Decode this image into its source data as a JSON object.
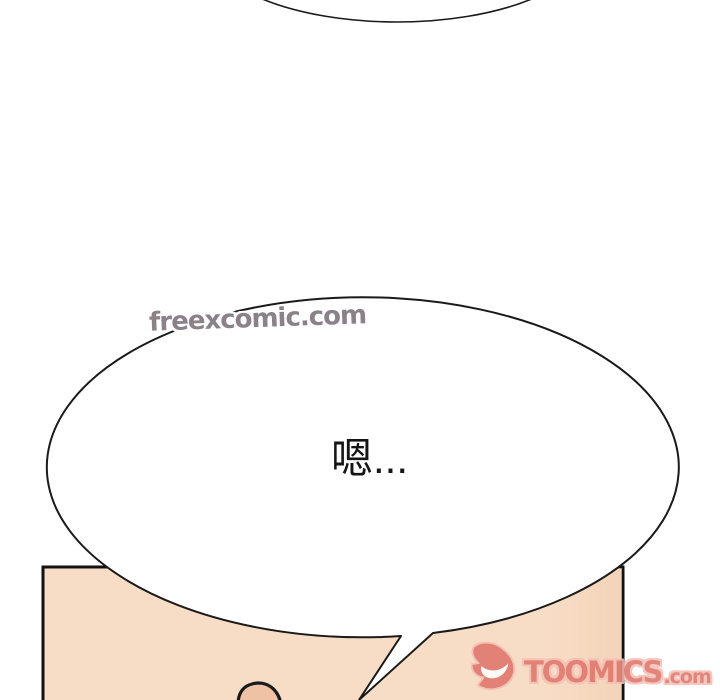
{
  "canvas": {
    "width": 720,
    "height": 700,
    "background": "#ffffff"
  },
  "watermark": {
    "text": "freexcomic.com",
    "color": "#8b8289",
    "outline_color": "#ffffff"
  },
  "dialogue_bubble": {
    "text": "嗯...",
    "text_color": "#151515",
    "fill": "#ffffff",
    "outline_color": "#1a1a1a"
  },
  "top_bubble": {
    "fill": "#ffffff",
    "outline_color": "#1a1a1a"
  },
  "panel": {
    "skin_color": "#f8ddc6",
    "shade_color": "#eec8a9",
    "border_color": "#111111",
    "nose_fill": "#f0c2a5"
  },
  "toomics_logo": {
    "icon": "toomics-devil-d-icon",
    "brand": "TOOMICS",
    "suffix": ".com",
    "fill": "#e0756a",
    "outline_color": "#f4bfb5"
  }
}
